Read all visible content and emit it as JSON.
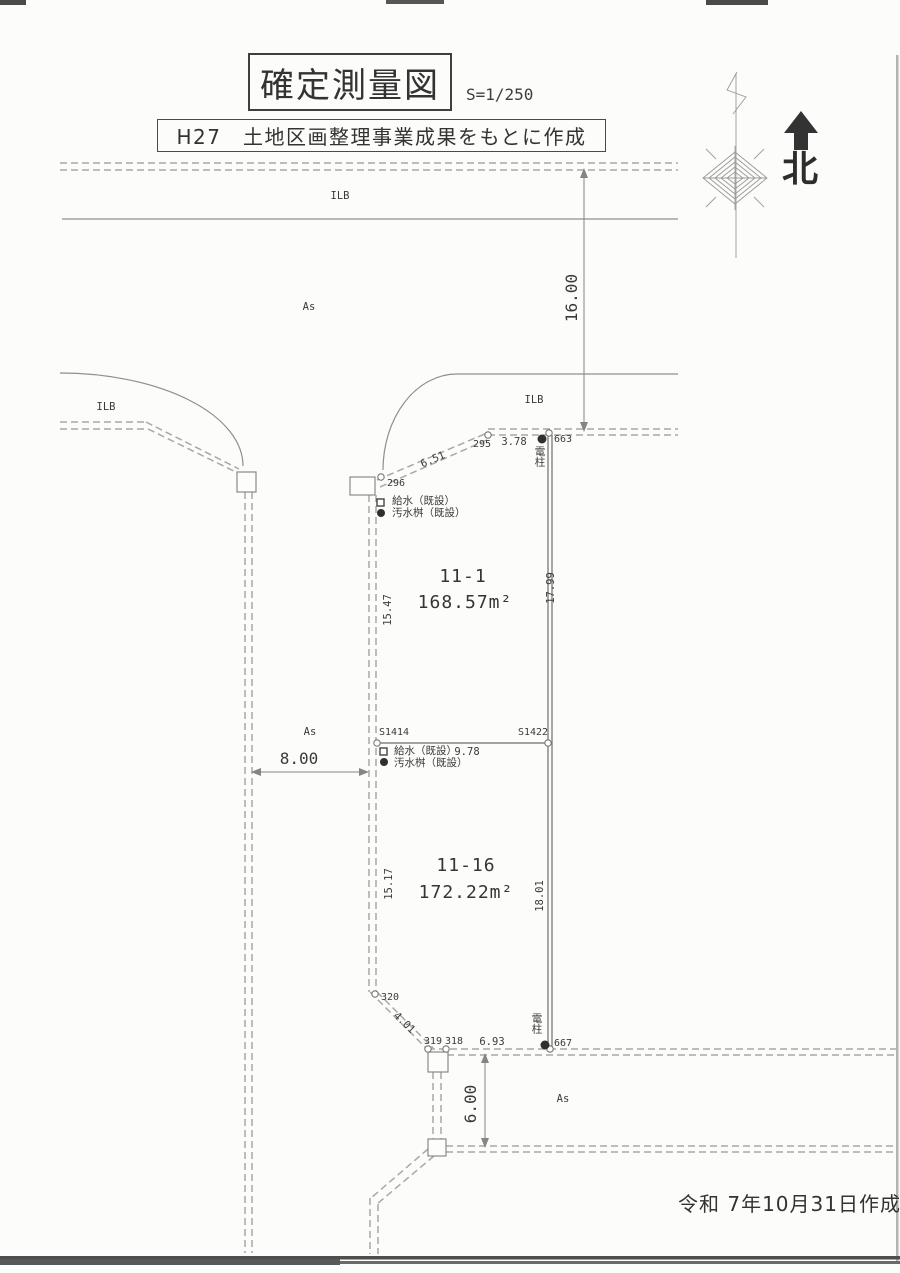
{
  "header": {
    "title": "確定測量図",
    "scale": "S=1/250",
    "subtitle": "H27　土地区画整理事業成果をもとに作成",
    "north_label": "北"
  },
  "footer": {
    "date_note": "令和 7年10月31日作成"
  },
  "parcels": [
    {
      "id": "11-1",
      "area": "168.57m²"
    },
    {
      "id": "11-16",
      "area": "172.22m²"
    }
  ],
  "surfaces": {
    "ilb": "ILB",
    "as": "As"
  },
  "dims": {
    "road_top_width": "16.00",
    "road_left_width": "8.00",
    "road_bottom_width": "6.00",
    "west_upper": "15.47",
    "west_lower": "15.17",
    "east_upper": "17.99",
    "east_lower": "18.01",
    "diag_upper": "6.51",
    "north_seg": "3.78",
    "mid_seg": "9.78",
    "diag_lower": "4.01",
    "south_seg": "6.93"
  },
  "points": {
    "p295": "295",
    "p296": "296",
    "p663": "663",
    "s1414": "S1414",
    "s1422": "S1422",
    "p320": "320",
    "p319": "319",
    "p318": "318",
    "p667": "667"
  },
  "utilities": {
    "pole": "電柱",
    "water_supply": "給水（既設）",
    "sewage_basin": "汚水桝（既設）"
  },
  "colors": {
    "ink": "#3a3a3a",
    "boundary_dash": "#a8a8a8",
    "pavement_line": "#8f8f8f",
    "paper": "#fcfcfa"
  }
}
